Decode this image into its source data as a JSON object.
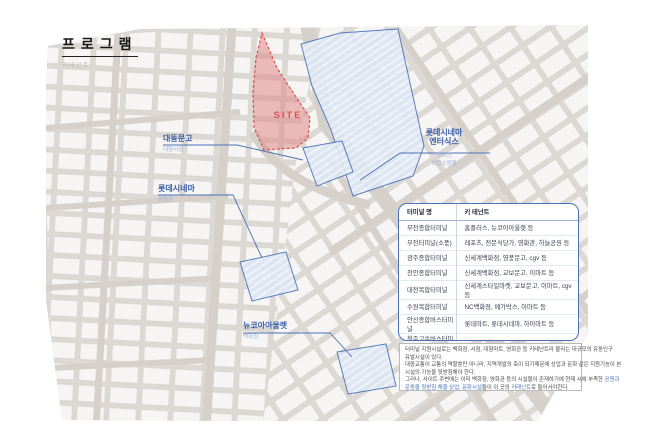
{
  "page": {
    "title": "프로그램",
    "subtitle": "키테넌트"
  },
  "site": {
    "label": "SITE"
  },
  "map_labels": [
    {
      "name": "대동문고",
      "subs": [
        "대형서점"
      ]
    },
    {
      "name": "롯데시네마",
      "subs": [
        "영화관"
      ]
    },
    {
      "name": "롯데시네마",
      "name2": "엔터식스",
      "subs": [
        "영화관",
        "복합쇼핑몰"
      ]
    },
    {
      "name": "뉴코아아울렛",
      "subs": [
        "백화점"
      ]
    }
  ],
  "table": {
    "headers": [
      "터미널 명",
      "키 테넌트"
    ],
    "rows": [
      [
        "부천종합터미널",
        "홈플러스, 뉴코아아울렛 등"
      ],
      [
        "부천터미널(소풍)",
        "레포츠, 전문식당가, 영화관, 하늘공원 등"
      ],
      [
        "광주종합터미널",
        "신세계백화점, 영풍문고, cgv 등"
      ],
      [
        "천안종합터미널",
        "신세계백화점, 교보문고, 이마트 등"
      ],
      [
        "대전복합터미널",
        "신세계스타일마켓, 교보문고, 이마트, cgv 등"
      ],
      [
        "수원복합터미널",
        "NC백화점, 메가박스, 이마트 등"
      ],
      [
        "안산종합버스터미널",
        "롯데마트, 롯데시네마, 하이마트 등"
      ],
      [
        "청주고속버스터미널",
        "신세계백화점, 교보문고, cgv 등"
      ]
    ]
  },
  "footnote": {
    "lines": [
      [
        {
          "t": "터미널 지원시설로는 백화점, 서점, 대형마트, 영화관 등 키테넌트라 불리는 대규모의 유동인구"
        }
      ],
      [
        {
          "t": "유발시설이 있다."
        }
      ],
      [
        {
          "t": "대중교통이 교통의 역할뿐만 아니라, 지역개발의 축이 되기때문에 상업과 문화 같은 지원기능이 본"
        }
      ],
      [
        {
          "t": "시설의 기능을 뒷받침해야 한다."
        }
      ],
      [
        {
          "t": "그러나, 사이트 주변에는 이미 백화점, 영화관 등의 시설물이 존재하기에 현재 시에 부족한 "
        },
        {
          "t": "공원과",
          "b": true
        }
      ],
      [
        {
          "t": "운동을 뒷받침 해줄 상업, 문화시설",
          "b": true
        },
        {
          "t": "들이 이 곳의 "
        },
        {
          "t": "키테넌트",
          "b": true
        },
        {
          "t": "로 들어서야한다."
        }
      ]
    ]
  },
  "colors": {
    "accent_blue": "#4a72b8",
    "label_blue": "#3a5fa8",
    "sub_blue": "#9db0d6",
    "site_red": "#d9534f",
    "site_fill": "#e8a3a3",
    "map_road": "#dcd8d3",
    "map_block": "#f6f5f3",
    "hatch_blue": "#dce6f3"
  }
}
